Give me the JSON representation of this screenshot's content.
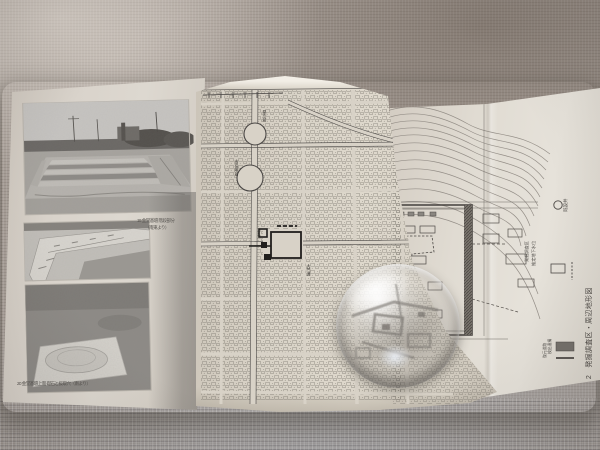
{
  "palette": {
    "fabric": "#a89f98",
    "paper": "#d8d2c6",
    "paper_bright": "#e4dfd6",
    "ink": "#4a4745",
    "photo_gray": "#b5b2ae"
  },
  "left_page": {
    "photo1_caption_l1": "19 金堂基壇 階段部分",
    "photo1_caption_l2": "（南東より）",
    "photo3_caption": "20 金堂基壇上面 礎石と抜取穴（南より）"
  },
  "map_page": {
    "labels": [
      "県庁前",
      "市役所前",
      "大門通"
    ]
  },
  "right_page": {
    "legend_well": "既設井",
    "legend_a": "発掘調査区",
    "legend_b": "推定地下水位",
    "legend_c": "検出遺構",
    "legend_d": "復元道路",
    "caption": "図版 2　発掘調査区・周辺地形図"
  }
}
